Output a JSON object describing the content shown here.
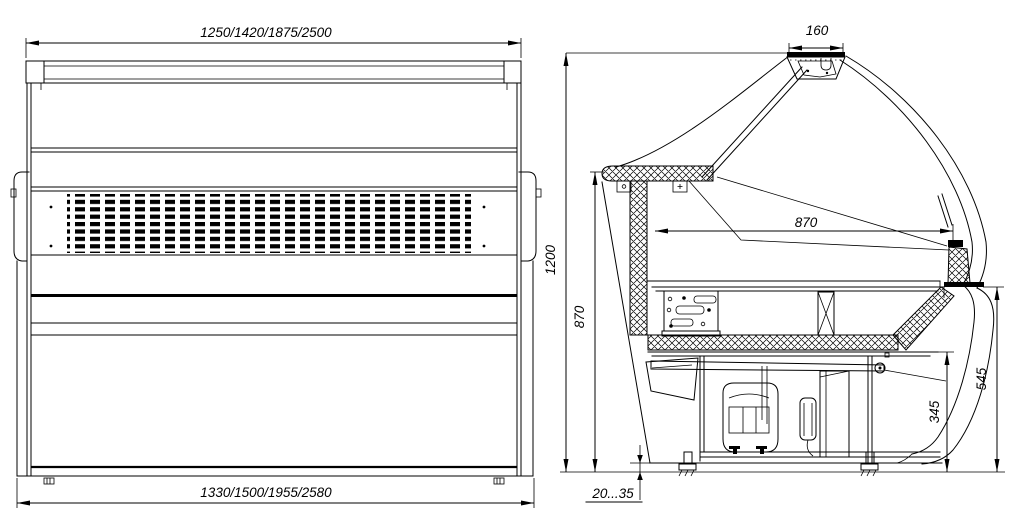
{
  "drawing": {
    "front_view": {
      "top_dimension": "1250/1420/1875/2500",
      "bottom_dimension": "1330/1500/1955/2580"
    },
    "side_view": {
      "canopy_width": "160",
      "overall_height": "1200",
      "back_counter_height": "870",
      "display_depth": "870",
      "front_height": "545",
      "machine_bay_height": "345",
      "floor_clearance": "20...35"
    },
    "colors": {
      "line": "#000000",
      "background": "#ffffff"
    }
  }
}
